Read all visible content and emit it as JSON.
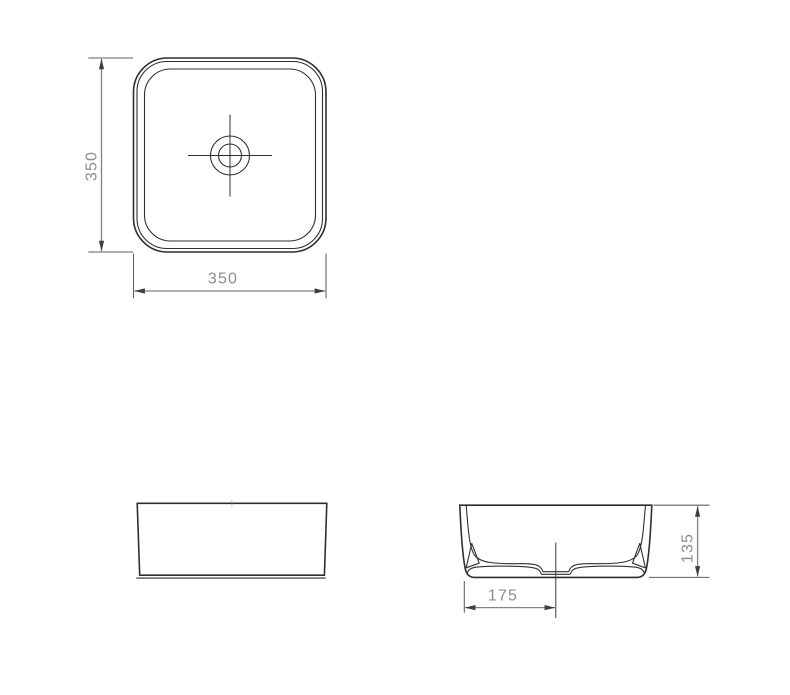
{
  "drawing": {
    "views": {
      "top_view": {
        "height_dim_label": "350",
        "width_dim_label": "350"
      },
      "section_view": {
        "height_dim_label": "135",
        "drain_center_dim_label": "175"
      }
    },
    "colors": {
      "background": "#ffffff",
      "object_line": "#2f2f2f",
      "dimension_line": "#828282",
      "dimension_text": "#8c8c8c"
    }
  }
}
